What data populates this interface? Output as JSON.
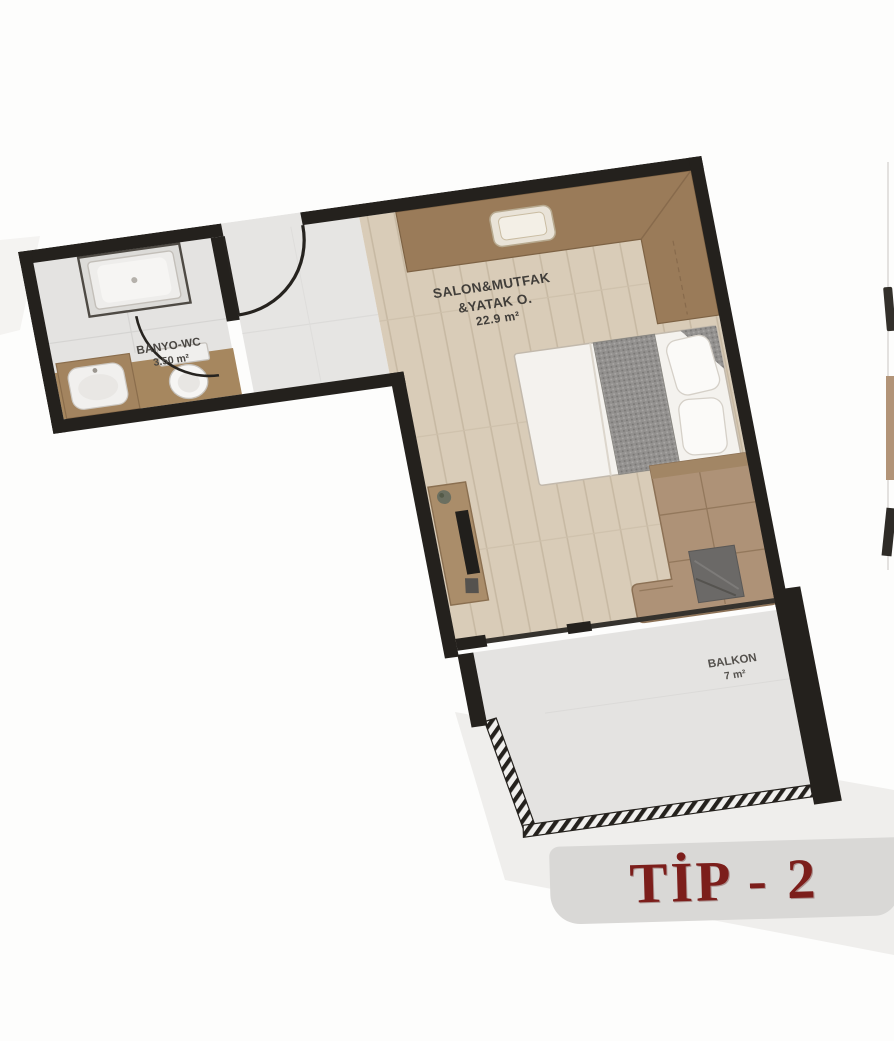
{
  "plan": {
    "type_label": "TİP - 2",
    "rooms": {
      "living": {
        "line1": "SALON&MUTFAK",
        "line2": "&YATAK O.",
        "area": "22.9 m²"
      },
      "bathroom": {
        "name": "BANYO-WC",
        "area": "3.50 m²"
      },
      "balcony": {
        "name": "BALKON",
        "area": "7 m²"
      }
    },
    "colors": {
      "wall": "#24211d",
      "wood_floor": "#d9ccb8",
      "tile_floor": "#e4e3e1",
      "counter_brown": "#9a7b59",
      "sofa_tan": "#ae9277",
      "title_red": "#7c1e1b",
      "title_band": "#d9d8d6"
    }
  }
}
